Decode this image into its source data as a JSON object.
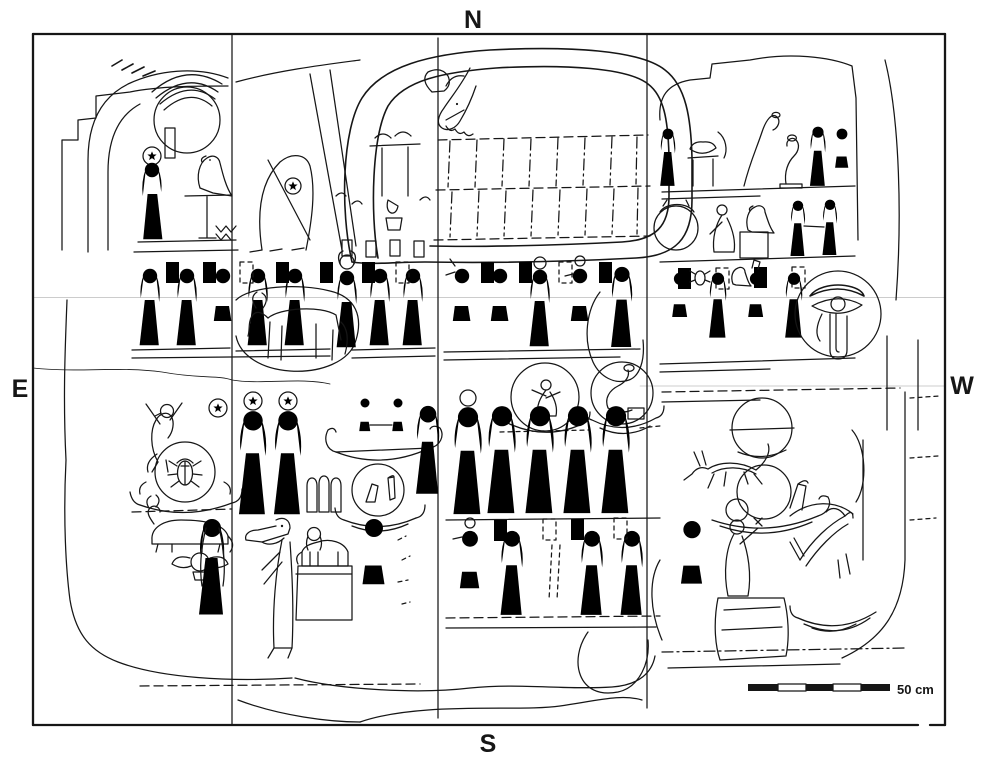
{
  "compass": {
    "north": "N",
    "south": "S",
    "east": "E",
    "west": "W"
  },
  "scale_bar": {
    "label": "50 cm"
  },
  "palette": {
    "ink": "#161616",
    "paper": "#ffffff"
  },
  "motifs": {
    "serpent": "coiled-serpent-with-grid",
    "sun": "hand-holding-sun-disk",
    "goddess": "goddess-with-star-disk",
    "falcon": "falcon-on-standard",
    "procession": "procession-of-deities-with-name-plaques",
    "decans": "decan-circles-on-barques",
    "scarab": "scarab-in-disk-on-barque",
    "wedjat": "wedjat-eye-in-disk",
    "barque": "solar-barque",
    "baboon": "baboon",
    "bull": "bull-figure",
    "cow": "recumbent-cow",
    "sphinx": "sphinx-on-pedestal",
    "crocodile": "crocodile-headed-deity",
    "jackal": "jackal-animal-on-barque",
    "horse": "rearing-quadruped",
    "scale": "scale-bar"
  }
}
